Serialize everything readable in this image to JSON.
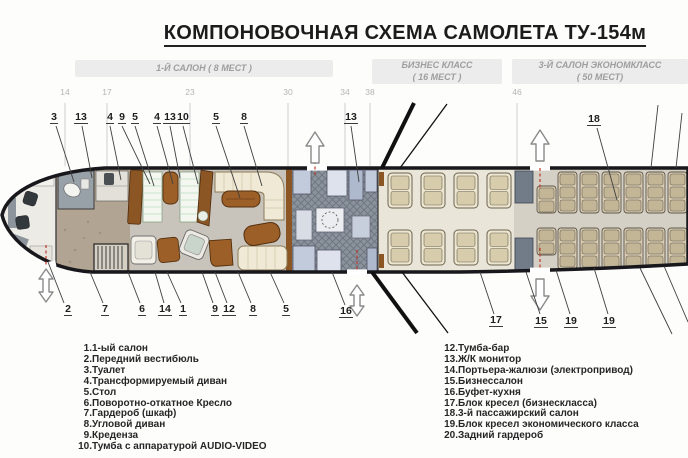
{
  "title": "КОМПОНОВОЧНАЯ СХЕМА САМОЛЕТА ТУ-154м",
  "sections": [
    {
      "line1": "1-Й САЛОН ( 8 МЕСТ )",
      "line2": ""
    },
    {
      "line1": "БИЗНЕС КЛАСС",
      "line2": "( 16 МЕСТ )"
    },
    {
      "line1": "3-Й САЛОН ЭКОНОМКЛАСС",
      "line2": "( 50 МЕСТ)"
    }
  ],
  "station_numbers": [
    "14",
    "17",
    "23",
    "30",
    "34",
    "38",
    "46"
  ],
  "callouts_top": [
    "3",
    "13",
    "4",
    "9",
    "5",
    "4",
    "13",
    "10",
    "5",
    "8",
    "13",
    "18"
  ],
  "callouts_bottom": [
    "2",
    "7",
    "6",
    "14",
    "1",
    "9",
    "12",
    "8",
    "5",
    "16",
    "17",
    "15",
    "19",
    "19"
  ],
  "legend_left": [
    {
      "n": "1.",
      "t": "1-ый салон"
    },
    {
      "n": "2.",
      "t": "Передний вестибюль"
    },
    {
      "n": "3.",
      "t": "Туалет"
    },
    {
      "n": "4.",
      "t": "Трансформируемый диван"
    },
    {
      "n": "5.",
      "t": "Стол"
    },
    {
      "n": "6.",
      "t": "Поворотно-откатное Кресло"
    },
    {
      "n": "7.",
      "t": "Гардероб (шкаф)"
    },
    {
      "n": "8.",
      "t": "Угловой диван"
    },
    {
      "n": "9.",
      "t": "Креденза"
    },
    {
      "n": "10.",
      "t": "Тумба с аппаратурой AUDIO-VIDEO"
    }
  ],
  "legend_right": [
    {
      "n": "12.",
      "t": "Тумба-бар"
    },
    {
      "n": "13.",
      "t": "Ж/К монитор"
    },
    {
      "n": "14.",
      "t": "Портьера-жалюзи (электропривод)"
    },
    {
      "n": "15.",
      "t": "Бизнессалон"
    },
    {
      "n": "16.",
      "t": "Буфет-кухня"
    },
    {
      "n": "17.",
      "t": "Блок кресел (бизнескласса)"
    },
    {
      "n": "18.",
      "t": "3-й пассажирский салон"
    },
    {
      "n": "19.",
      "t": "Блок кресел экономического класса"
    },
    {
      "n": "20.",
      "t": "Задний гардероб"
    }
  ],
  "colors": {
    "wood_accent": "#9c5f28",
    "sofa_cream": "#f0e9d5",
    "galley_blue": "#c2cbdb",
    "door_path_red": "#c0392b",
    "section_label_gray": "#9e9e9e",
    "fuselage_outline": "#17171c"
  }
}
